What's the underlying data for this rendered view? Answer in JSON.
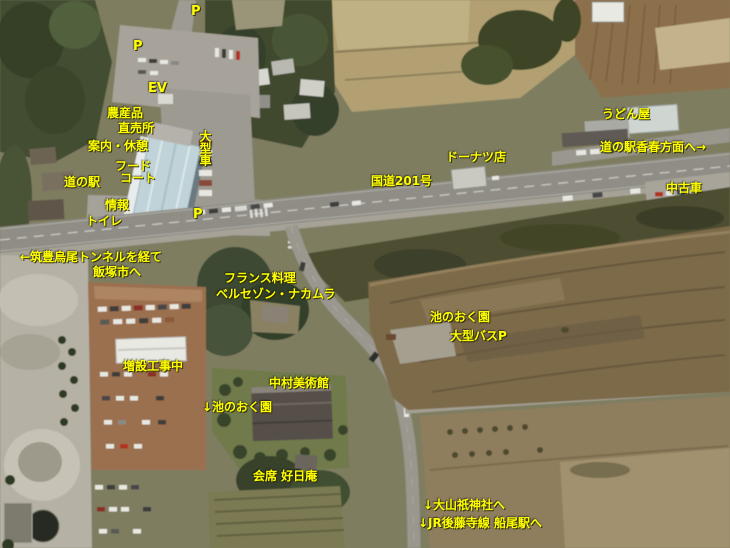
{
  "map": {
    "kind": "annotated aerial / satellite photo",
    "annotation_color": "#ffff00",
    "labels": {
      "parking_top": "P",
      "parking_mid": "P",
      "ev": "EV",
      "farm_shop_line1": "農産品",
      "farm_shop_line2": "直売所",
      "info_rest": "案内・休憩",
      "food_court_line1": "フード",
      "food_court_line2": "コート",
      "michinoeki": "道の駅",
      "info": "情報",
      "toilet": "トイレ",
      "large_vehicle": "大型車",
      "parking_lot": "P",
      "udon_shop": "うどん屋",
      "kawara_direction": "道の駅香春方面へ→",
      "used_cars": "中古車",
      "donut_shop": "ドーナツ店",
      "route201": "国道201号",
      "tunnel_line1": "←筑豊烏尾トンネルを経て",
      "tunnel_line2": "飯塚市へ",
      "french_line1": "フランス料理",
      "french_line2": "ベルセゾン・ナカムラ",
      "ikenooku_garden": "池のおく園",
      "bus_parking": "大型バスP",
      "construction": "増設工事中",
      "museum": "中村美術館",
      "ikenooku_down": "↓池のおく園",
      "kaiseki": "会席 好日庵",
      "shrine": "↓大山祇神社へ",
      "jr_station": "↓JR後藤寺線 船尾駅へ"
    }
  }
}
